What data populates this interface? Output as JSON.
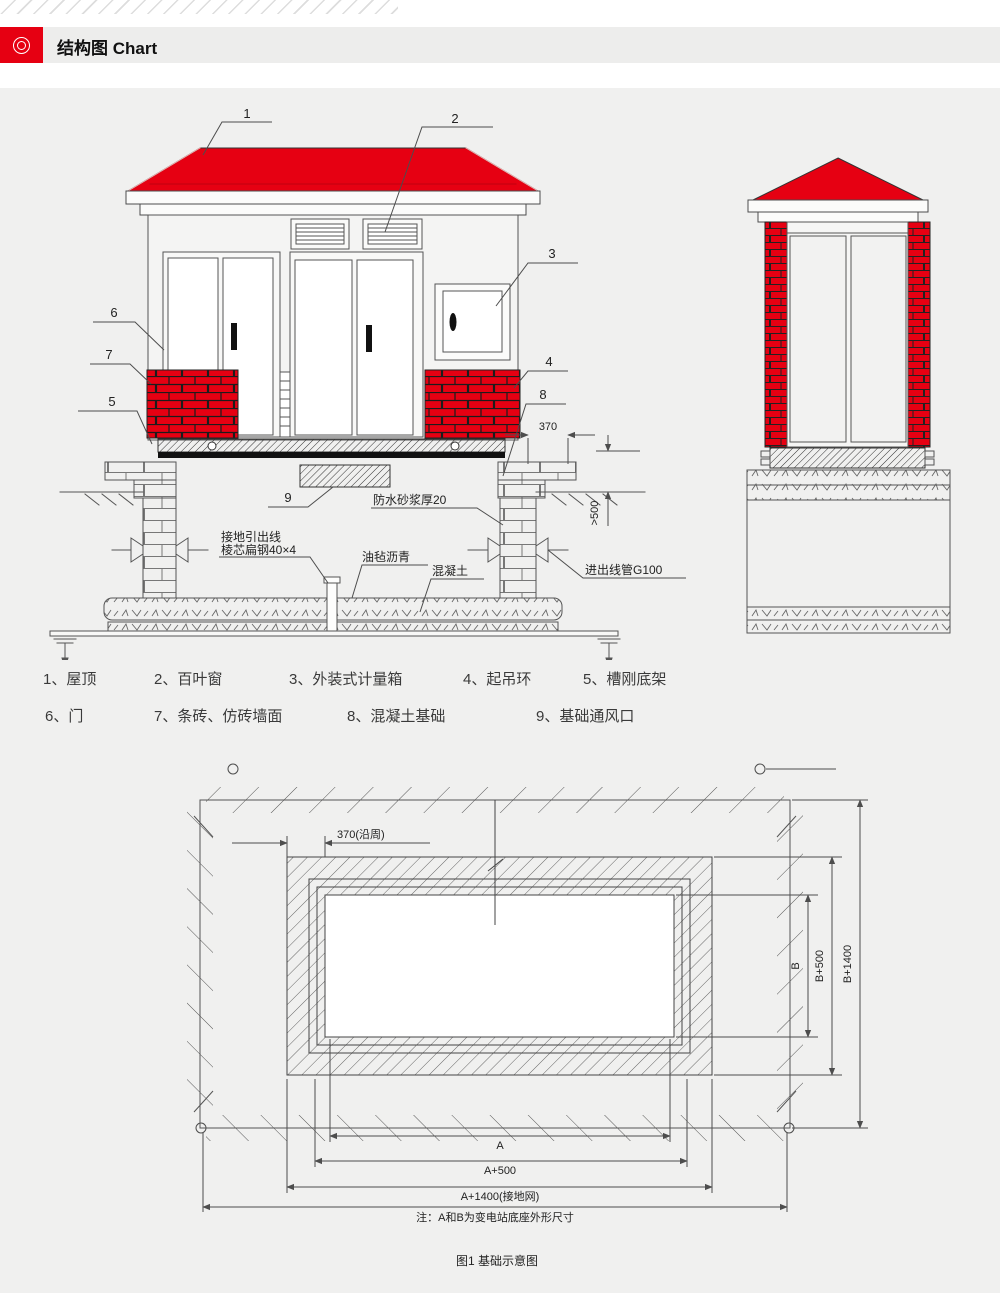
{
  "header": {
    "title": "结构图 Chart"
  },
  "colors": {
    "accent_red": "#e60012",
    "line": "#4d4d4d",
    "panel_bg": "#f0f0ef"
  },
  "elevation": {
    "callouts": {
      "c1": "1",
      "c2": "2",
      "c3": "3",
      "c4": "4",
      "c5": "5",
      "c6": "6",
      "c7": "7",
      "c8": "8",
      "c9": "9"
    },
    "dims": {
      "d370": "370",
      "d500": ">500"
    },
    "notes": {
      "waterproof": "防水砂浆厚20",
      "ground_lead_1": "接地引出线",
      "ground_lead_2": "棱芯扁钢40×4",
      "asphalt_felt": "油毡沥青",
      "concrete": "混凝土",
      "conduit": "进出线管G100"
    }
  },
  "legend": {
    "row1": [
      "1、屋顶",
      "2、百叶窗",
      "3、外装式计量箱",
      "4、起吊环",
      "5、槽刚底架"
    ],
    "row2": [
      "6、门",
      "7、条砖、仿砖墙面",
      "8、混凝土基础",
      "9、基础通风口"
    ]
  },
  "plan": {
    "dim_370": "370(沿周)",
    "dim_a": "A",
    "dim_a500": "A+500",
    "dim_a1400": "A+1400(接地网)",
    "dim_b": "B",
    "dim_b500": "B+500",
    "dim_b1400": "B+1400",
    "note": "注：A和B为变电站底座外形尺寸",
    "caption": "图1 基础示意图"
  }
}
